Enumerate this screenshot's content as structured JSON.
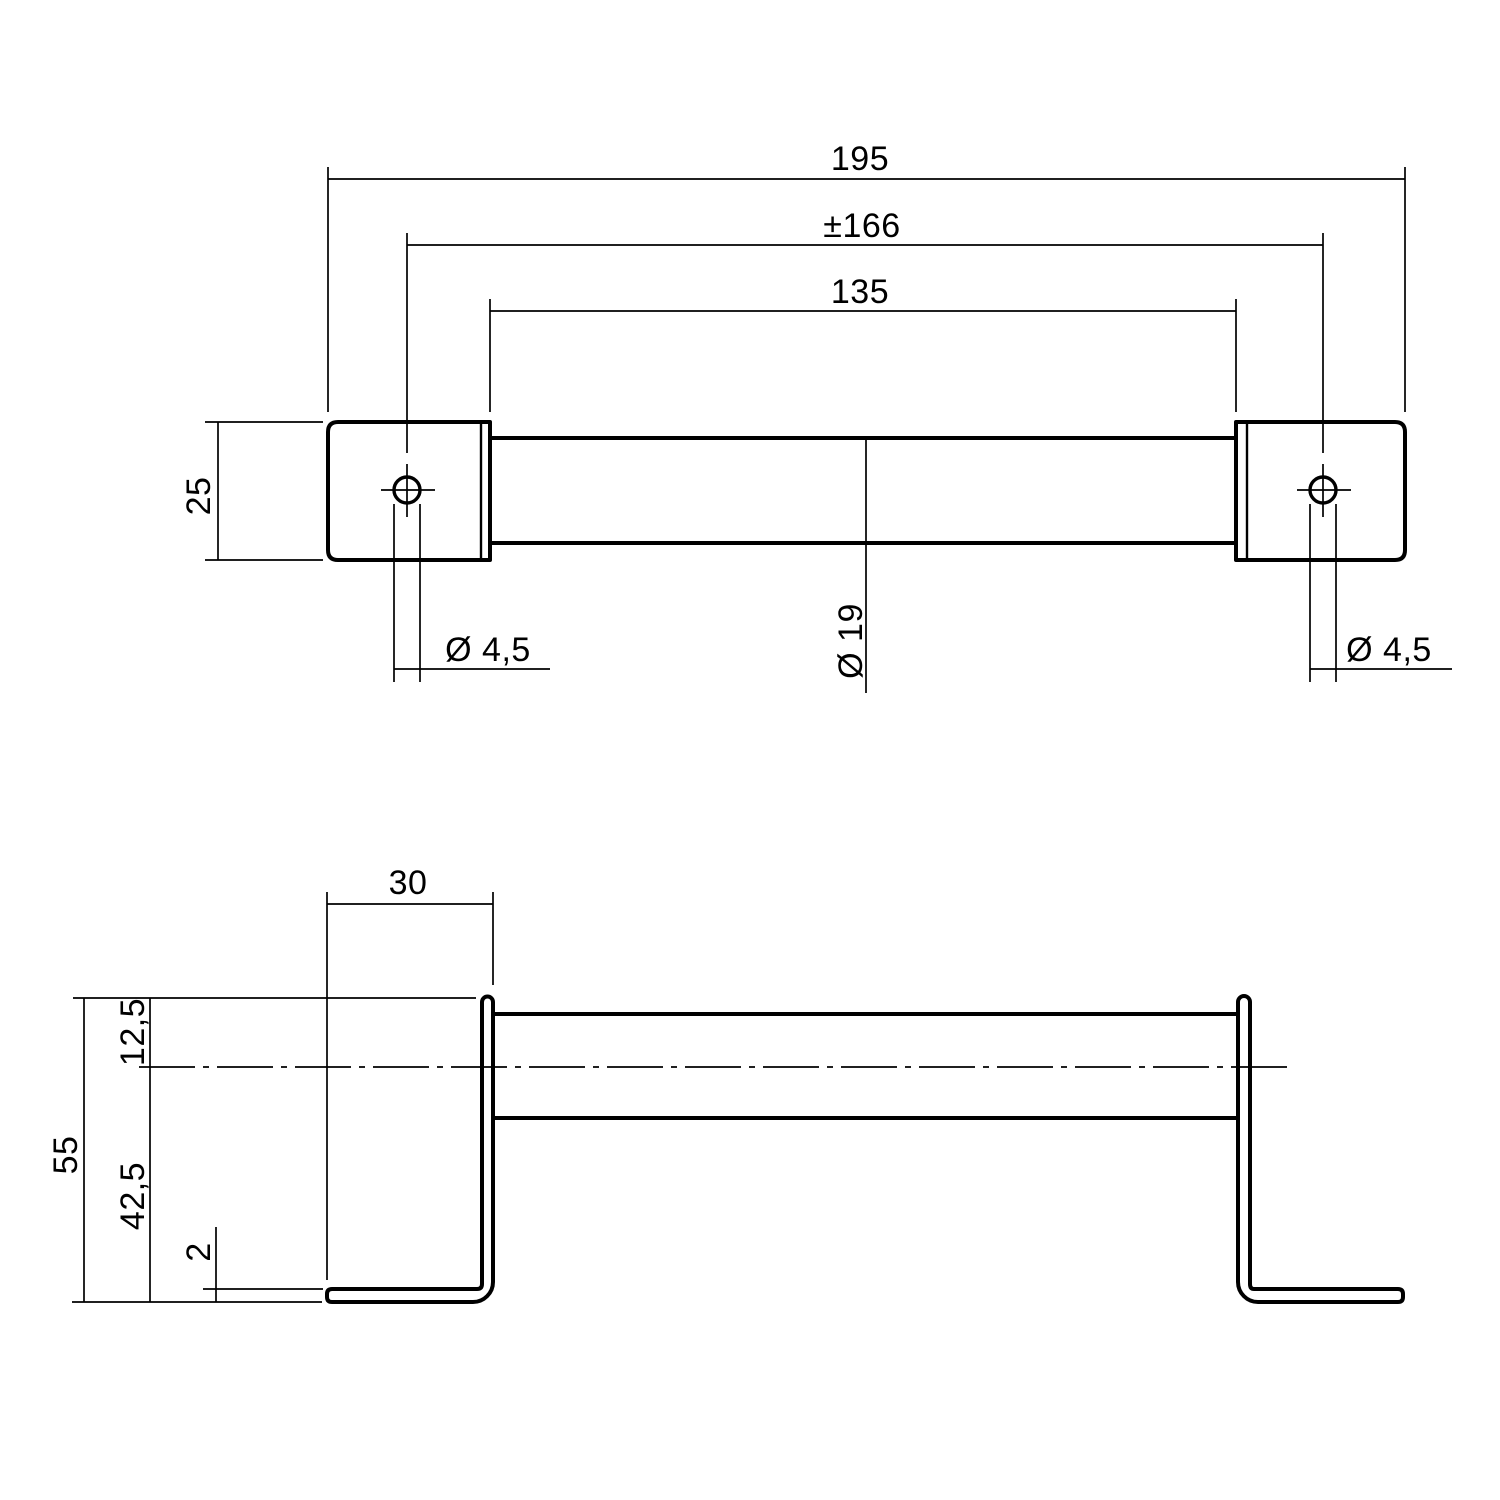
{
  "drawing": {
    "background": "#ffffff",
    "line_color": "#000000",
    "front_view": {
      "dims": {
        "overall_width": "195",
        "hole_spacing": "±166",
        "grip_length": "135",
        "block_size": "25",
        "hole_diameter_left": "Ø 4,5",
        "hole_diameter_right": "Ø 4,5",
        "bar_diameter": "Ø 19"
      }
    },
    "side_view": {
      "dims": {
        "bracket_depth": "30",
        "top_to_axis": "12,5",
        "axis_to_bottom": "42,5",
        "overall_height": "55",
        "material_thickness": "2"
      }
    }
  }
}
